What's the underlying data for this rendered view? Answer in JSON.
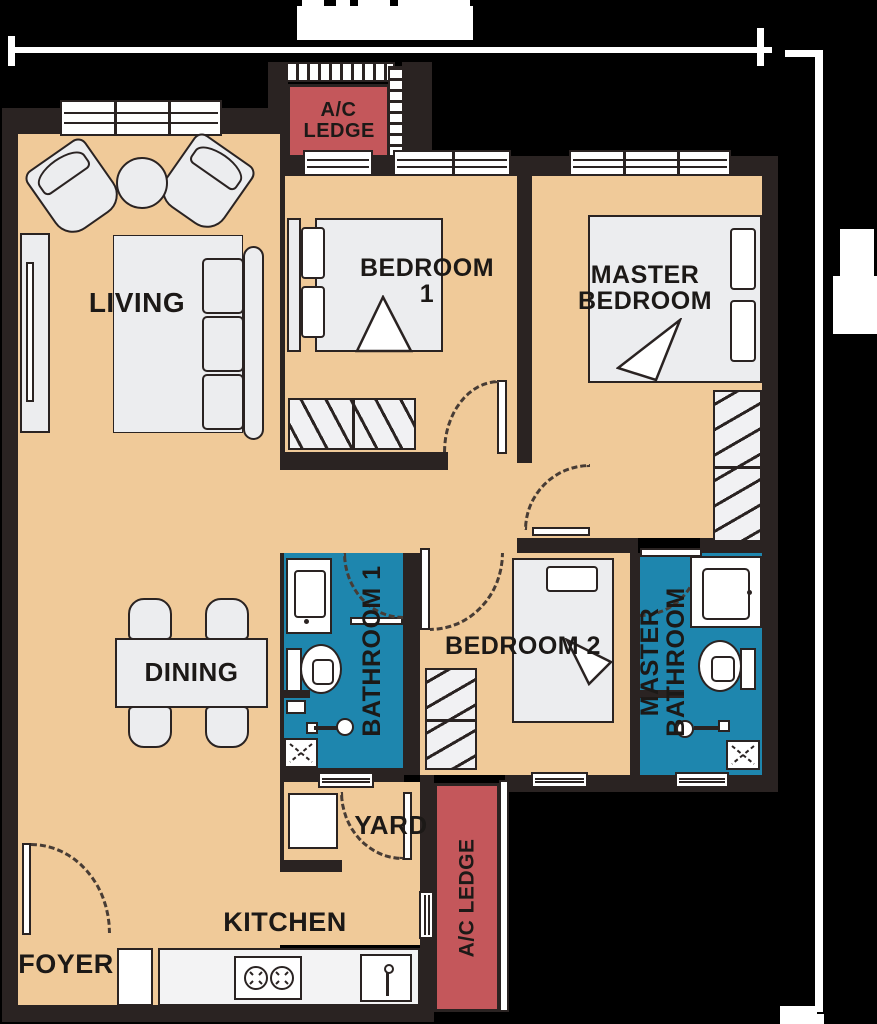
{
  "plan": {
    "rooms": {
      "living": "LIVING",
      "dining": "DINING",
      "bedroom1": "BEDROOM 1",
      "master_bedroom": "MASTER BEDROOM",
      "bedroom2": "BEDROOM 2",
      "bathroom1": "BATHROOM 1",
      "master_bathroom": "MASTER BATHROOM",
      "yard": "YARD",
      "kitchen": "KITCHEN",
      "foyer": "FOYER",
      "ac_ledge_top": "A/C LEDGE",
      "ac_ledge_bottom": "A/C LEDGE"
    },
    "colors": {
      "background": "#000000",
      "wall": "#2a2322",
      "floor": "#f0ca99",
      "bathroom": "#1e86ae",
      "ac_ledge": "#c4575b",
      "furniture": "#ecedef",
      "dimension_line": "#ffffff"
    }
  }
}
